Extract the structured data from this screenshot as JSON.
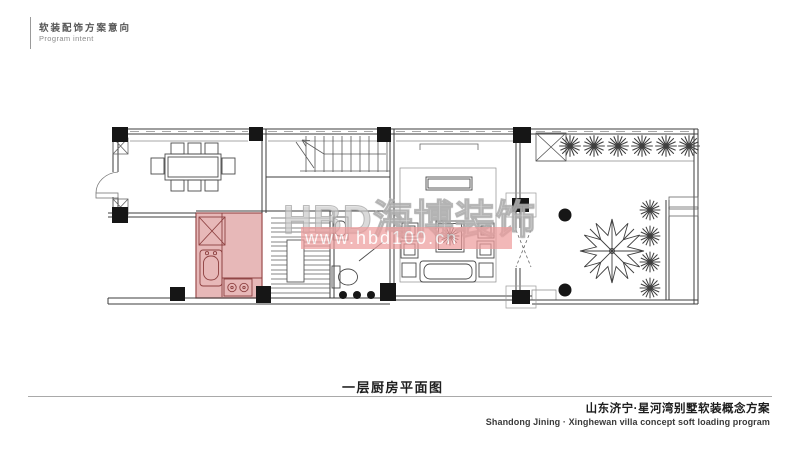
{
  "header": {
    "title_cn": "软装配饰方案意向",
    "title_en": "Program intent"
  },
  "watermark": {
    "brand": "HBD海博装饰",
    "url": "www.hbd100.cn"
  },
  "plan": {
    "caption": "一层厨房平面图",
    "highlighted_room": "kitchen"
  },
  "footer": {
    "project_cn": "山东济宁·星河湾别墅软装概念方案",
    "project_en": "Shandong Jining · Xinghewan villa concept soft loading program"
  },
  "colors": {
    "kitchen_fill": "#e5b3b3",
    "kitchen_stroke": "#9a4848",
    "watermark_band": "#ee9d9d",
    "watermark_text": "#c3c3c3",
    "line": "#3c3c3c"
  }
}
